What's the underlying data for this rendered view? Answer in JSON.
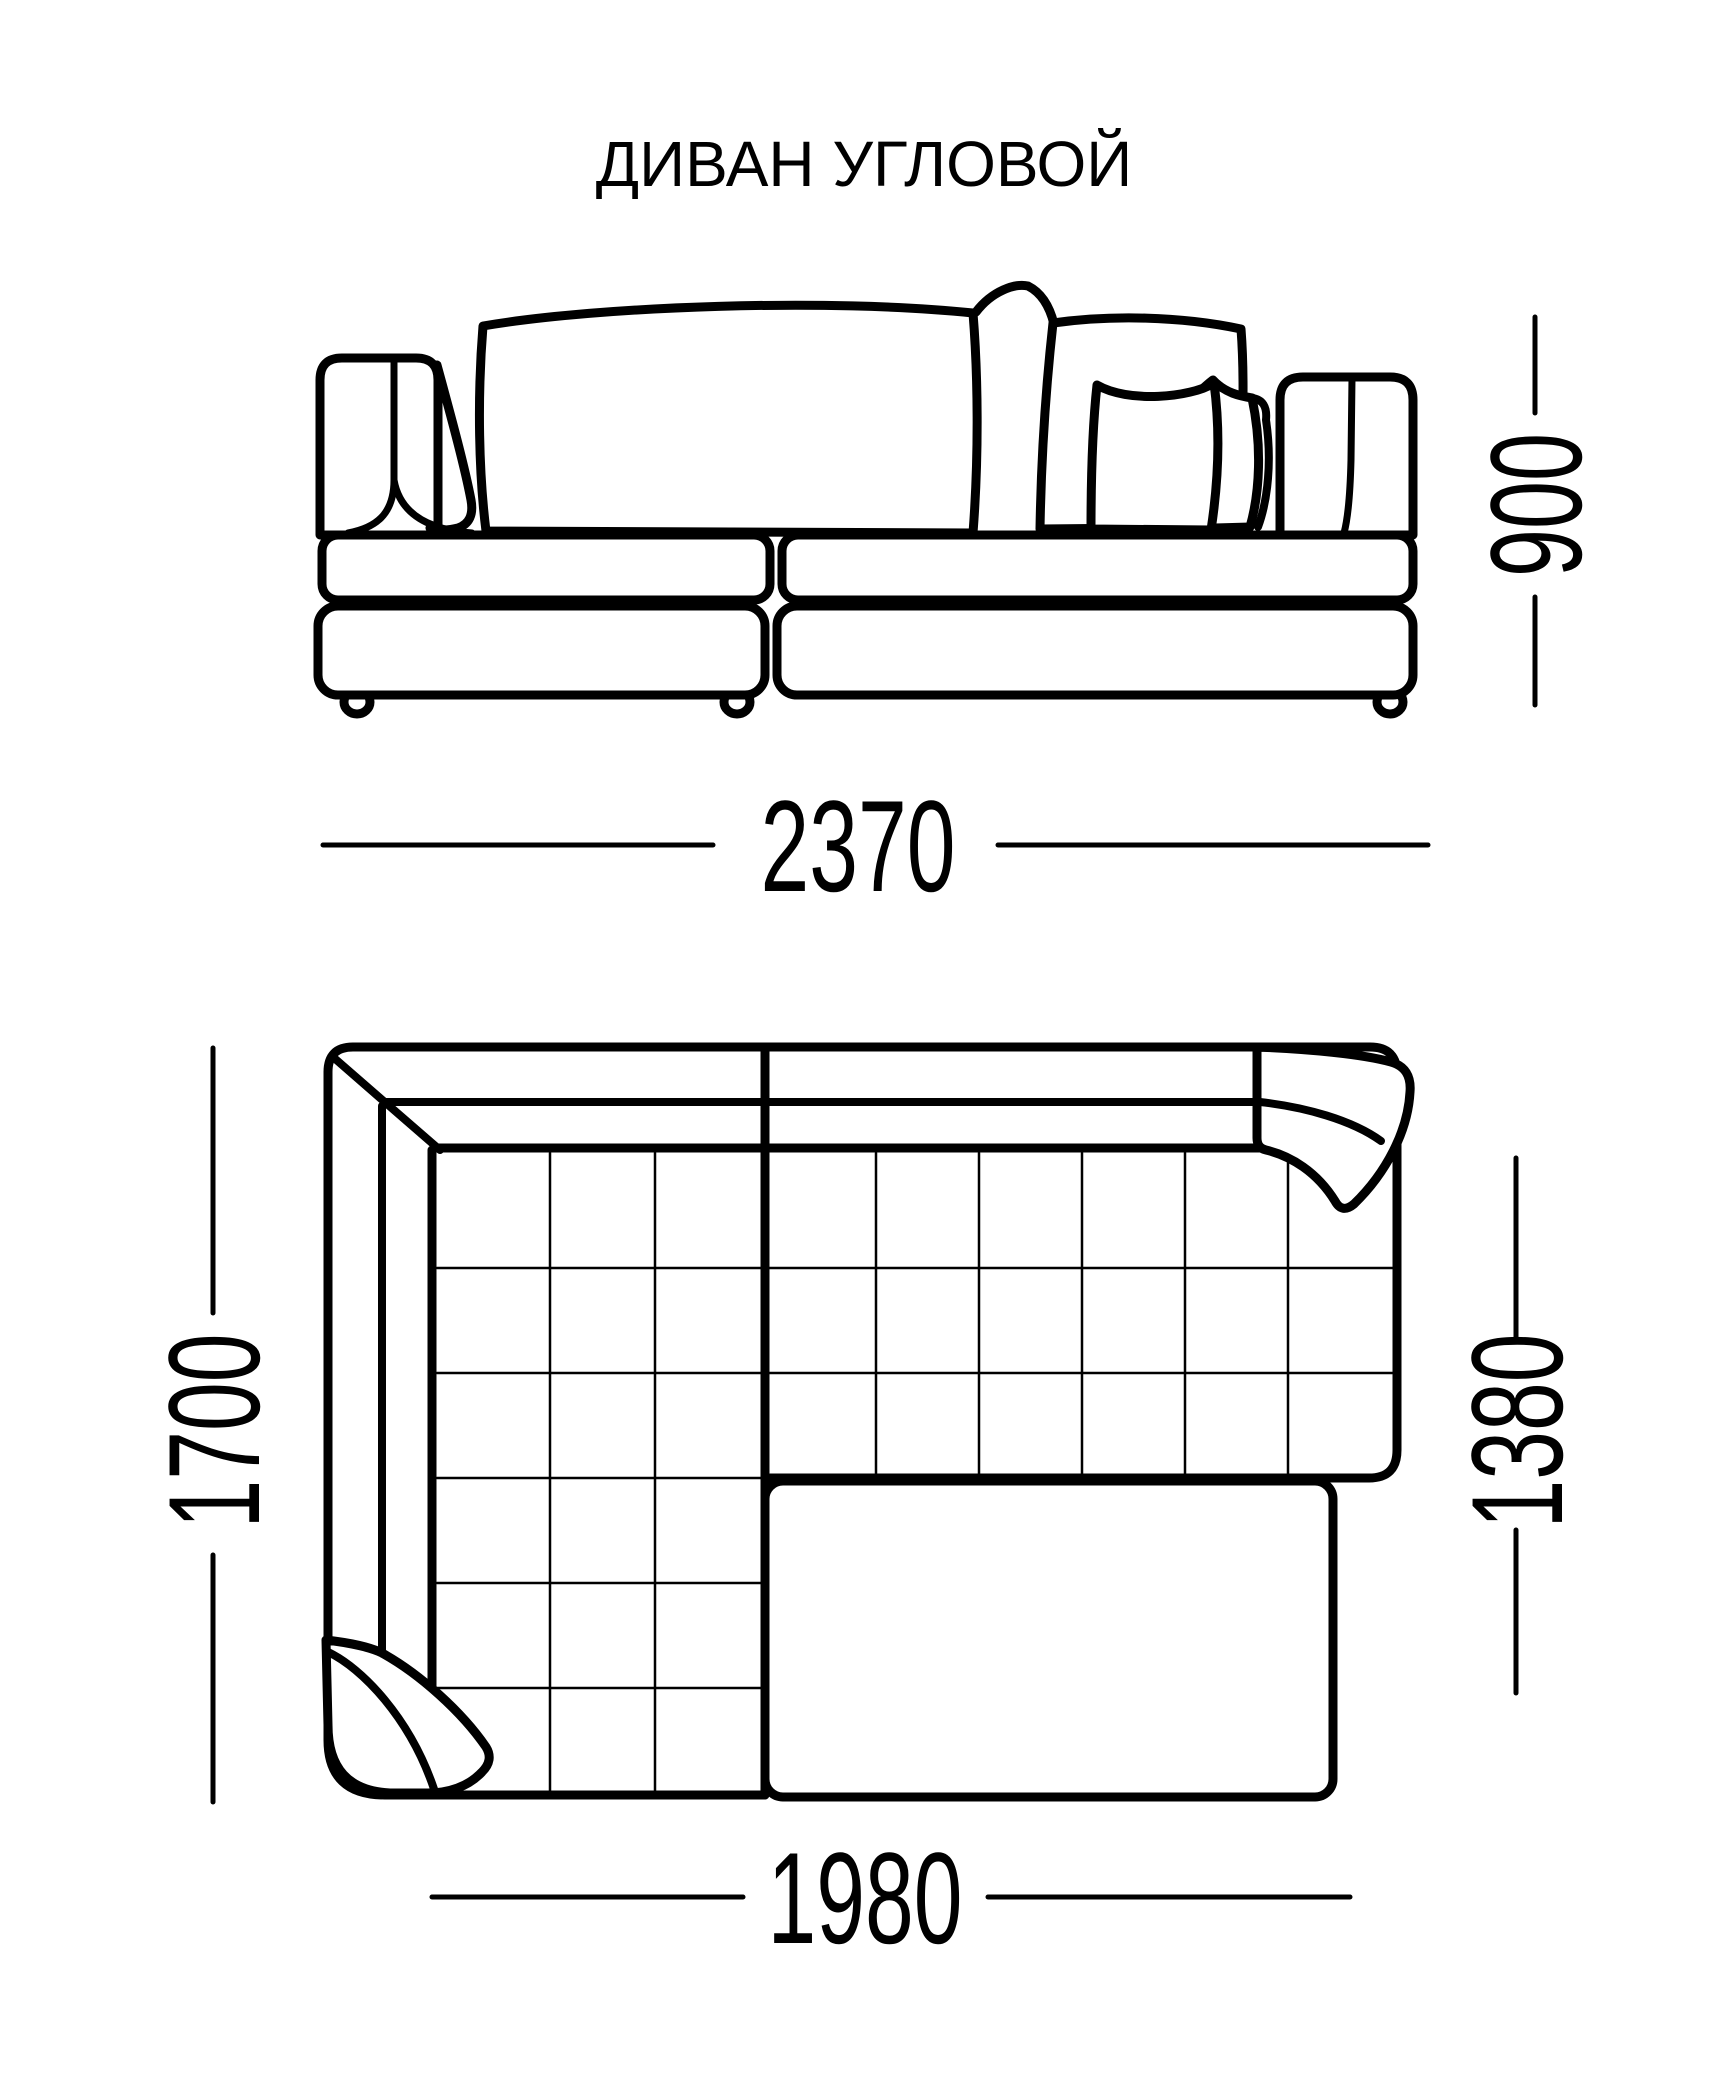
{
  "title": "ДИВАН УГЛОВОЙ",
  "drawing_type": "corner sofa technical drawing, two orthographic views",
  "front_view": {
    "description": "front elevation of sofa with back pillows, two armrests, two seat bands and feet",
    "width_label": "2370",
    "height_label": "900"
  },
  "top_view": {
    "description": "plan view with quilt grid seats, backrest bands, left armrest, corner pillows and plain ottoman",
    "height_left_label": "1700",
    "height_right_label": "1380",
    "width_bottom_label": "1980"
  },
  "colors": {
    "line": "#000000",
    "background": "#ffffff"
  }
}
